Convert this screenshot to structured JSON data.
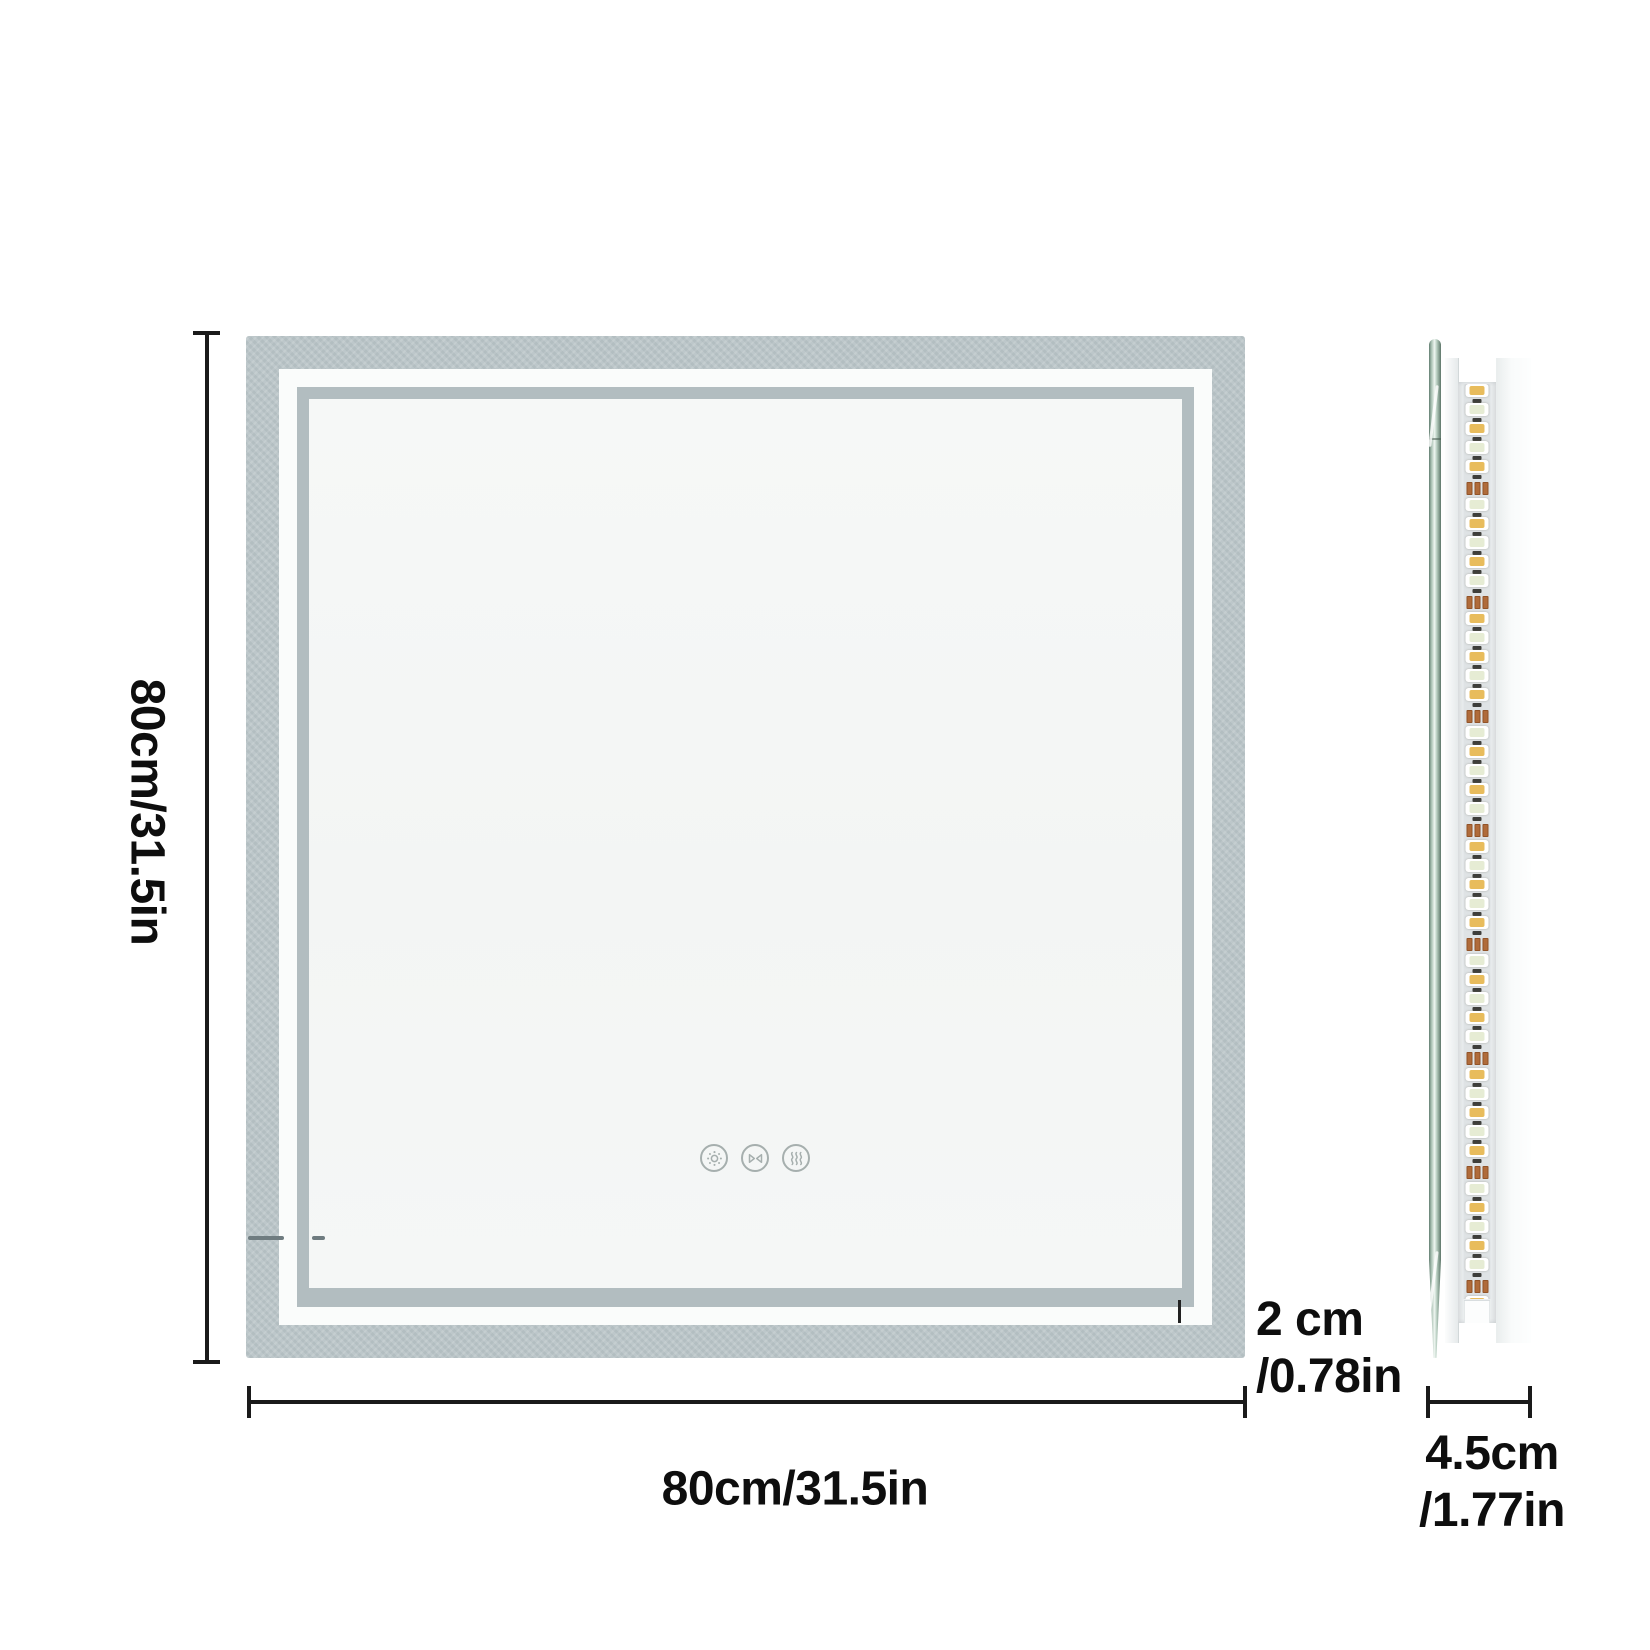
{
  "diagram": {
    "subject": "led-bathroom-mirror-dimension-diagram",
    "views": [
      "front-view",
      "side-view"
    ]
  },
  "dims": {
    "height_label": "80cm/31.5in",
    "width_label": "80cm/31.5in",
    "frame_line1": "2 cm",
    "frame_line2": "/0.78in",
    "depth_line1": "4.5cm",
    "depth_line2": "/1.77in"
  },
  "controls": {
    "icons": [
      "brightness-icon",
      "flip-triangles-icon",
      "defog-icon"
    ]
  },
  "colors": {
    "frame_frost": "#b9c4c7",
    "light_band": "#fafcfb",
    "inner_border": "#b2bdc0",
    "mirror_face": "#f4f6f5",
    "dimension_line": "#1a1a1a",
    "icon_gray": "#a6afae",
    "glass_edge": "#627d70"
  },
  "led_strip": {
    "units": 49,
    "pitch_px": 19,
    "resistor_every": 6,
    "package_color": "#ffffff",
    "led_color_a": "#e8bc5c",
    "led_color_b": "#e6ecd4",
    "chip_color": "#3e3e3a",
    "resistor_color": "#b06b3a",
    "strip_bg": "#dfe3e5"
  }
}
